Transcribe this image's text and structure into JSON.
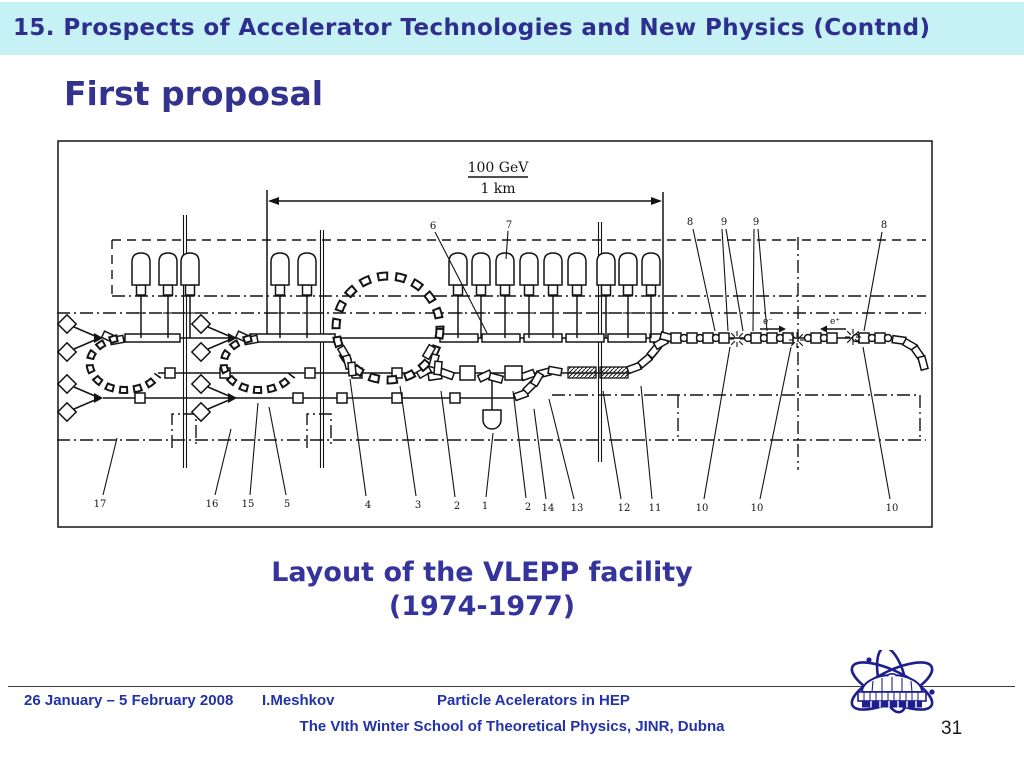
{
  "slide": {
    "header": {
      "title": "15. Prospects of Accelerator Technologies and New Physics (Contnd)",
      "bg_color": "#c7f2f5",
      "text_color": "#2e2e8f"
    },
    "subtitle": "First proposal",
    "caption": {
      "line1": "Layout of the VLEPP facility",
      "line2": "(1974-1977)"
    },
    "page_number": "31"
  },
  "figure": {
    "scale": {
      "numerator": "100 GeV",
      "denominator": "1 km"
    },
    "top_labels": [
      "6",
      "7",
      "8",
      "9",
      "9",
      "8"
    ],
    "bottom_labels": [
      "17",
      "16",
      "15",
      "5",
      "4",
      "3",
      "2",
      "1",
      "2",
      "14",
      "13",
      "12",
      "11",
      "10",
      "10",
      "10"
    ],
    "beam_labels": {
      "electron": "e⁻",
      "positron": "e⁺"
    }
  },
  "footer": {
    "date_range": "26 January – 5 February 2008",
    "author": "I.Meshkov",
    "course_title": "Particle Acelerators in HEP",
    "school_line": "The VIth Winter School of Theoretical Physics, JINR, Dubna",
    "text_color": "#2232aa"
  },
  "logo": {
    "label": "jinr-logo",
    "color": "#1e1e8e"
  }
}
